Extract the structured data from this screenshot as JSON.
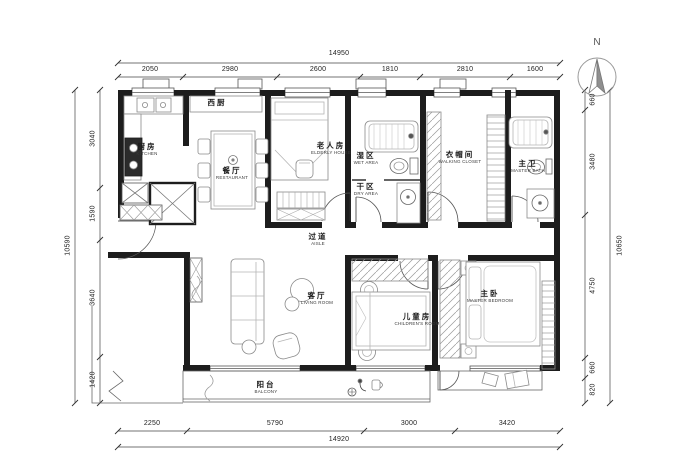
{
  "compass": {
    "label": "N"
  },
  "dimensions": {
    "top": {
      "overall": "14950",
      "segments": [
        "2050",
        "2980",
        "2600",
        "1810",
        "2810",
        "1600"
      ]
    },
    "bottom": {
      "overall": "14920",
      "segments": [
        "2250",
        "5790",
        "3000",
        "3420"
      ]
    },
    "left": {
      "overall": "10590",
      "segments": [
        "3040",
        "1590",
        "3640",
        "1420"
      ]
    },
    "right": {
      "overall": "10650",
      "segments": [
        "660",
        "3480",
        "4750",
        "660",
        "820"
      ]
    }
  },
  "rooms": {
    "kitchen": {
      "zh": "厨房",
      "en": "KITCHEN"
    },
    "west_kitchen": {
      "zh": "西厨",
      "en": ""
    },
    "dining": {
      "zh": "餐厅",
      "en": "RESTAURANT"
    },
    "elderly": {
      "zh": "老人房",
      "en": "ELDERLY HOUSE"
    },
    "wet_area": {
      "zh": "湿区",
      "en": "WET AREA"
    },
    "dry_area": {
      "zh": "干区",
      "en": "DRY AREA"
    },
    "closet": {
      "zh": "衣帽间",
      "en": "WALKING CLOSET"
    },
    "master_bath": {
      "zh": "主卫",
      "en": "MASTER BATH"
    },
    "aisle": {
      "zh": "过道",
      "en": "AISLE"
    },
    "living": {
      "zh": "客厅",
      "en": "LIVING ROOM"
    },
    "children": {
      "zh": "儿童房",
      "en": "CHILDREN'S ROOM"
    },
    "master_bedroom": {
      "zh": "主卧",
      "en": "MASTER BEDROOM"
    },
    "balcony": {
      "zh": "阳台",
      "en": "BALCONY"
    }
  },
  "colors": {
    "wall": "#1d1d1d",
    "furniture_line": "#8a8a8a",
    "dim_line": "#444444",
    "background": "#ffffff"
  }
}
